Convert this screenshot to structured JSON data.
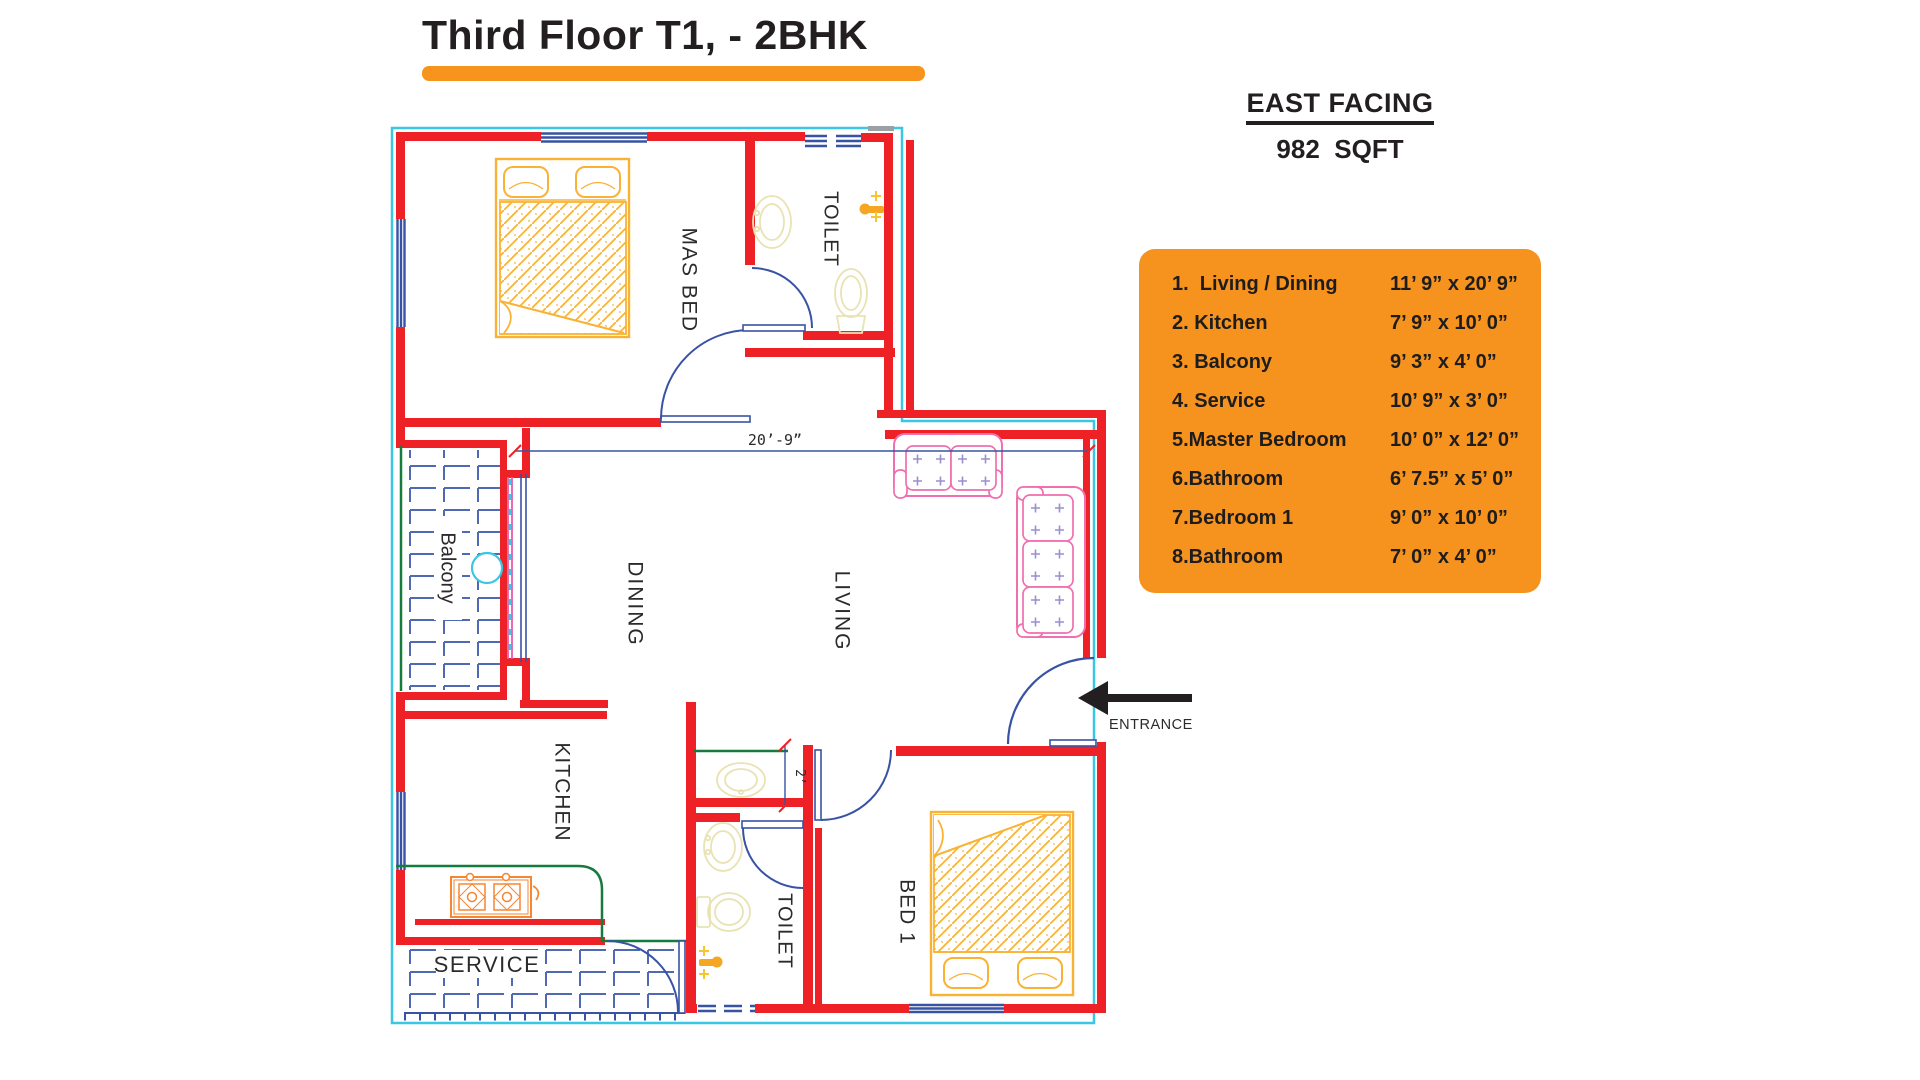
{
  "title": "Third Floor T1, - 2BHK",
  "facing": {
    "direction": "EAST FACING",
    "area": "982  SQFT"
  },
  "legend": {
    "rooms": [
      {
        "name": "1.  Living / Dining",
        "size": "11’ 9” x 20’ 9”"
      },
      {
        "name": "2. Kitchen",
        "size": "7’ 9” x 10’ 0”"
      },
      {
        "name": "3. Balcony",
        "size": "9’ 3” x 4’ 0”"
      },
      {
        "name": "4. Service",
        "size": "10’ 9” x 3’ 0”"
      },
      {
        "name": "5.Master Bedroom",
        "size": "10’ 0” x 12’ 0”"
      },
      {
        "name": "6.Bathroom",
        "size": "6’ 7.5” x 5’ 0”"
      },
      {
        "name": "7.Bedroom 1",
        "size": "9’ 0” x 10’ 0”"
      },
      {
        "name": "8.Bathroom",
        "size": "7’ 0” x 4’ 0”"
      }
    ]
  },
  "plan": {
    "labels": {
      "master_bed": "MAS BED",
      "toilet_top": "TOILET",
      "balcony": "Balcony",
      "dining": "DINING",
      "living": "LIVING",
      "kitchen": "KITCHEN",
      "service": "SERVICE",
      "toilet_bottom": "TOILET",
      "bed1": "BED 1"
    },
    "dimensions": {
      "living_width": "20’-9”",
      "passage": "2’"
    },
    "entrance_label": "ENTRANCE"
  },
  "colors": {
    "accent_orange": "#F7941E",
    "wall_red": "#EE2226",
    "boundary_cyan": "#3BC6E4",
    "window_blue": "#3853A4",
    "tile_blue": "#5069B5",
    "furniture_yellow": "#F9B233",
    "sofa_pink": "#F06FAE",
    "cushion_lavender": "#9B8FD0",
    "counter_green": "#177A3F",
    "stove_orange": "#F58634",
    "fixture_pale": "#E9E2B3",
    "text_dark": "#231F20"
  }
}
